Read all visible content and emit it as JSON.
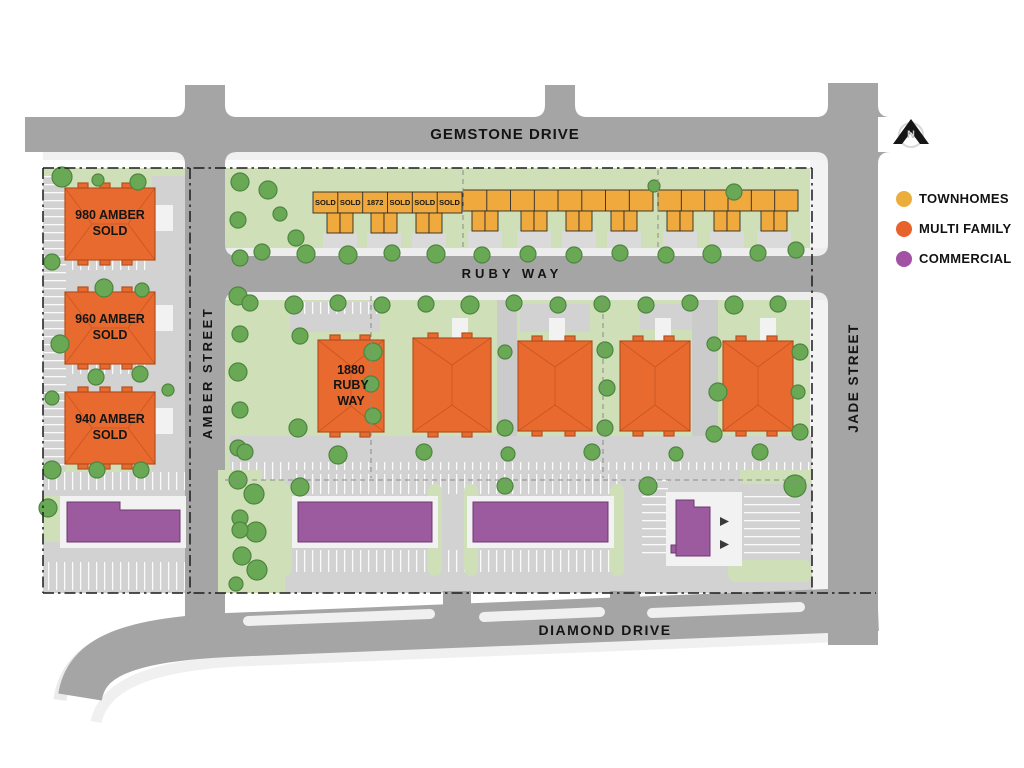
{
  "roads": {
    "gemstone": "GEMSTONE DRIVE",
    "ruby": "RUBY WAY",
    "diamond": "DIAMOND DRIVE",
    "amber": "AMBER STREET",
    "jade": "JADE STREET"
  },
  "north_arrow": {
    "label": "N"
  },
  "legend": {
    "items": [
      {
        "label": "TOWNHOMES",
        "color": "#EBAE3C"
      },
      {
        "label": "MULTI FAMILY",
        "color": "#E8622B"
      },
      {
        "label": "COMMERCIAL",
        "color": "#A351A5"
      }
    ]
  },
  "buildings": {
    "amber_980": {
      "label": "980 AMBER\nSOLD",
      "type": "multi_family"
    },
    "amber_960": {
      "label": "960 AMBER\nSOLD",
      "type": "multi_family"
    },
    "amber_940": {
      "label": "940 AMBER\nSOLD",
      "type": "multi_family"
    },
    "ruby_1880": {
      "label": "1880\nRUBY\nWAY",
      "type": "multi_family"
    }
  },
  "townhome_units": [
    "SOLD",
    "SOLD",
    "1872",
    "SOLD",
    "SOLD",
    "SOLD"
  ],
  "colors": {
    "townhomes": "#EFA93D",
    "multi_family": "#E96A2F",
    "commercial": "#9B5B9E",
    "road_gray": "#A5A5A5",
    "landscape_green": "#CFE0B8",
    "tree_green": "#69A854"
  }
}
